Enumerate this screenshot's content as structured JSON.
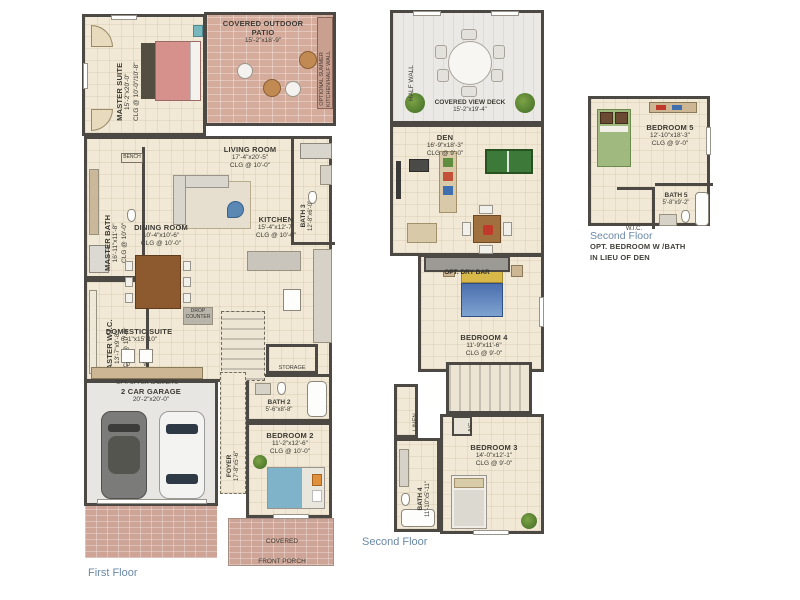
{
  "captions": {
    "first_floor": "First Floor",
    "second_floor": "Second Floor"
  },
  "colors": {
    "wall": "#4c4944",
    "floor_beige": "#f1e9d6",
    "patio_brick": "#d5ab9c",
    "caption_blue": "#6b89a6"
  },
  "f": {
    "master_suite": {
      "name": "MASTER SUITE",
      "dims": "15'-2\"x20'-0\"",
      "clg": "CLG @ 10'-0\"/10'-8\""
    },
    "patio": {
      "name": "COVERED OUTDOOR PATIO",
      "dims": "15'-2\"x18'-9\""
    },
    "summer_kitchen": {
      "line1": "OPTIONAL SUMMER",
      "line2": "KITCHEN/HALF WALL"
    },
    "living_room": {
      "name": "LIVING ROOM",
      "dims": "17'-4\"x20'-5\"",
      "clg": "CLG @ 10'-0\""
    },
    "master_bath": {
      "name": "MASTER BATH",
      "dims": "16'-11\"x11'-8\"",
      "clg": "CLG @ 10'-0\""
    },
    "bench": {
      "name": "BENCH"
    },
    "bath3": {
      "name": "BATH 3",
      "dims": "12'-8\"x6'-0\""
    },
    "dining_room": {
      "name": "DINING ROOM",
      "dims": "10'-4\"x10'-6\"",
      "clg": "CLG @ 10'-0\""
    },
    "kitchen": {
      "name": "KITCHEN",
      "dims": "15'-4\"x12'-7\"",
      "clg": "CLG @ 10'-0\""
    },
    "master_wic": {
      "name": "MASTER W.I.C.",
      "dims": "13'-7\"x9'-8\"",
      "clg": "CLG @ 10'-0\""
    },
    "domestic_suite": {
      "name": "DOMESTIC SUITE",
      "dims": "6'-1\"x15'-10\""
    },
    "drop_counter": {
      "name": "DROP COUNTER"
    },
    "washer": "D",
    "dryer": "W",
    "opt_upper_cabinets": "OPT. UPPER CABINETS",
    "garage": {
      "name": "2 CAR GARAGE",
      "dims": "20'-2\"x20'-0\""
    },
    "foyer": {
      "name": "FOYER",
      "dims": "17'-8\"x5'-6\""
    },
    "storage": {
      "name": "STORAGE"
    },
    "bath2": {
      "name": "BATH 2",
      "dims": "5'-6\"x8'-8\""
    },
    "bedroom2": {
      "name": "BEDROOM 2",
      "dims": "11'-2\"x12'-6\"",
      "clg": "CLG @ 10'-0\""
    },
    "porch": {
      "name": "COVERED FRONT PORCH"
    }
  },
  "s": {
    "half_wall": "HALF WALL",
    "view_deck": {
      "name": "COVERED VIEW DECK",
      "dims": "15'-2\"x19'-4\""
    },
    "den": {
      "name": "DEN",
      "dims": "16'-9\"x18'-3\"",
      "clg": "CLG @ 9'-0\""
    },
    "dry_bar": "OPT. DRY BAR",
    "bedroom4": {
      "name": "BEDROOM 4",
      "dims": "11'-9\"x11'-6\"",
      "clg": "CLG @ 9'-0\""
    },
    "linen": "LINEN",
    "ac": "A/C",
    "bath4": {
      "name": "BATH 4",
      "dims": "11'-10\"x5'-11\""
    },
    "bedroom3": {
      "name": "BEDROOM 3",
      "dims": "14'-0\"x12'-1\"",
      "clg": "CLG @ 9'-0\""
    }
  },
  "o": {
    "bedroom5": {
      "name": "BEDROOM 5",
      "dims": "12'-10\"x18'-3\"",
      "clg": "CLG @ 9'-0\""
    },
    "wic": "W.I.C.",
    "bath5": {
      "name": "BATH 5",
      "dims": "5'-8\"x9'-2\""
    },
    "caption_title": "Second Floor",
    "note1": "OPT. BEDROOM W /BATH",
    "note2": "IN LIEU OF DEN"
  }
}
